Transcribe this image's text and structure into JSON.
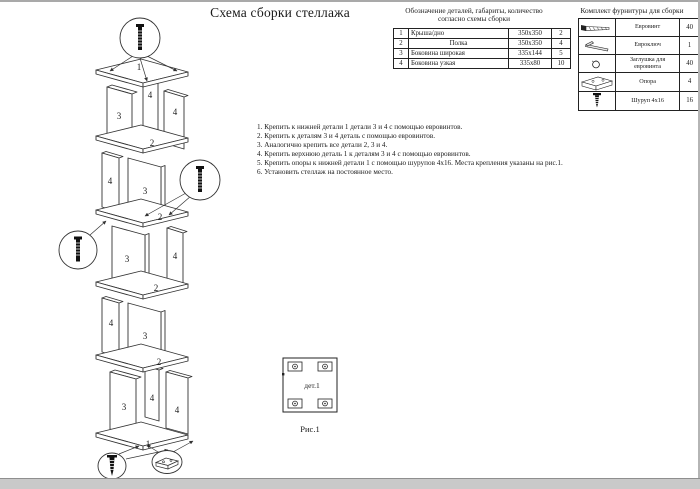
{
  "colors": {
    "ink": "#1a1a1a",
    "line": "#333333",
    "page_bg": "#ffffff",
    "footer_bar": "#c9c9c9"
  },
  "title": "Схема сборки стеллажа",
  "parts_table": {
    "caption_line1": "Обозначение деталей, габариты, количество",
    "caption_line2": "согласно схемы сборки",
    "rows": [
      {
        "num": "1",
        "name": "Крыша/дно",
        "size": "350х350",
        "qty": "2"
      },
      {
        "num": "2",
        "name": "Полка",
        "size": "350х350",
        "qty": "4"
      },
      {
        "num": "3",
        "name": "Боковина широкая",
        "size": "335х144",
        "qty": "5"
      },
      {
        "num": "4",
        "name": "Боковина узкая",
        "size": "335х80",
        "qty": "10"
      }
    ]
  },
  "hardware_table": {
    "caption": "Комплект фурнитуры для сборки",
    "rows": [
      {
        "icon": "euro-screw-icon",
        "name": "Евровинт",
        "qty": "40"
      },
      {
        "icon": "hex-key-icon",
        "name": "Евроключ",
        "qty": "1"
      },
      {
        "icon": "plug-icon",
        "name": "Заглушка для евровинта",
        "qty": "40"
      },
      {
        "icon": "support-foot-icon",
        "name": "Опора",
        "qty": "4"
      },
      {
        "icon": "wood-screw-icon",
        "name": "Шуруп 4х16",
        "qty": "16"
      }
    ]
  },
  "instructions": [
    "1. Крепить к нижней детали 1 детали 3 и 4 с помощью евровинтов.",
    "2. Крепить к деталям 3 и 4 деталь с помощью евровинтов.",
    "3. Аналогично крепить все детали 2, 3 и 4.",
    "4. Крепить верхнюю деталь 1 к деталям 3 и 4 с помощью евровинтов.",
    "5. Крепить опоры к нижней детали 1 с помощью шурупов 4х16. Места крепления указаны на рис.1.",
    "6. Установить стеллаж на постоянное место."
  ],
  "figure": {
    "part_label": "дет.1",
    "caption": "Рис.1"
  },
  "diagram": {
    "part_labels": [
      "1",
      "4",
      "3",
      "4",
      "2",
      "4",
      "3",
      "2",
      "3",
      "4",
      "2",
      "4",
      "3",
      "2",
      "3",
      "4",
      "4",
      "1"
    ]
  }
}
